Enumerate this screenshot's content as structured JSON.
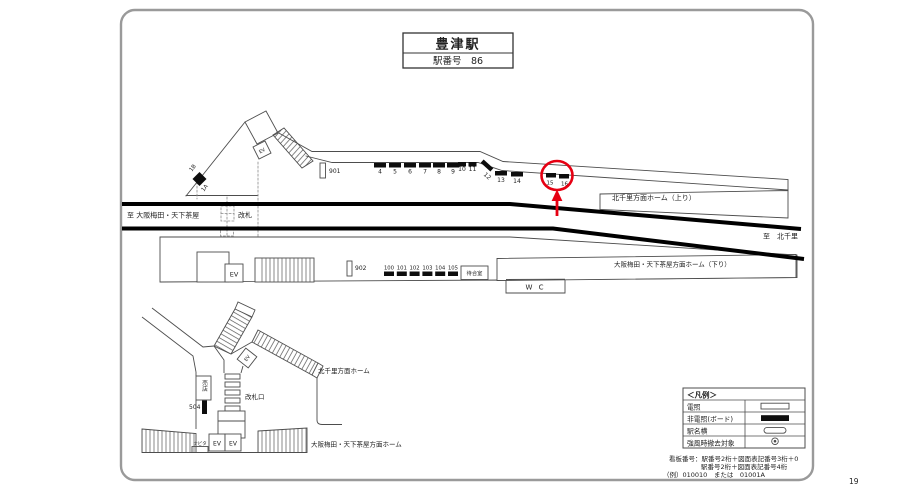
{
  "title": {
    "station": "豊津駅",
    "station_no": "駅番号　86"
  },
  "tracks": {
    "to_left": "至 大阪梅田・天下茶屋",
    "to_right": "至　北千里"
  },
  "upper": {
    "kaisatsu": "改札",
    "sign901": "901",
    "marker_top": "1B",
    "marker_bottom": "1A",
    "ev": "EV",
    "boards1": [
      "4",
      "5",
      "6",
      "7",
      "8",
      "9"
    ],
    "boards2": [
      "10",
      "11"
    ],
    "board12": "12",
    "boards3": [
      "13",
      "14"
    ],
    "boards4": [
      "15",
      "16"
    ],
    "platform_label": "北千里方面ホーム（上り）"
  },
  "lower": {
    "ev": "EV",
    "sign902": "902",
    "boards": [
      "100",
      "101",
      "102",
      "103",
      "104",
      "105"
    ],
    "waiting": "待合室",
    "wc": "W C",
    "platform_label": "大阪梅田・天下茶屋方面ホーム（下り）"
  },
  "street": {
    "ev_stairs": "EV",
    "shop": "売店",
    "board504": "504",
    "gate_label": "改札口",
    "navita": "ナビタ",
    "ev_left": "EV",
    "ev_right": "EV",
    "platform_north": "北千里方面ホーム",
    "platform_south": "大阪梅田・天下茶屋方面ホーム"
  },
  "legend": {
    "title": "＜凡例＞",
    "rows": [
      {
        "label": "電照",
        "symbol": "illuminated-panel"
      },
      {
        "label": "非電照(ボード)",
        "symbol": "non-illuminated-board"
      },
      {
        "label": "駅名横",
        "symbol": "station-name-side"
      },
      {
        "label": "強風時撤去対象",
        "symbol": "storm-removal-target"
      }
    ]
  },
  "notes": {
    "line1": "看板番号：駅番号2桁＋図面表記番号3桁＋0",
    "line2": "駅番号2桁＋図面表記番号4桁",
    "line3": "（例）010010　または　01001A"
  },
  "page_number": "19",
  "colors": {
    "highlight": "#e60012",
    "track": "#000000",
    "line": "#4d4d4d"
  }
}
